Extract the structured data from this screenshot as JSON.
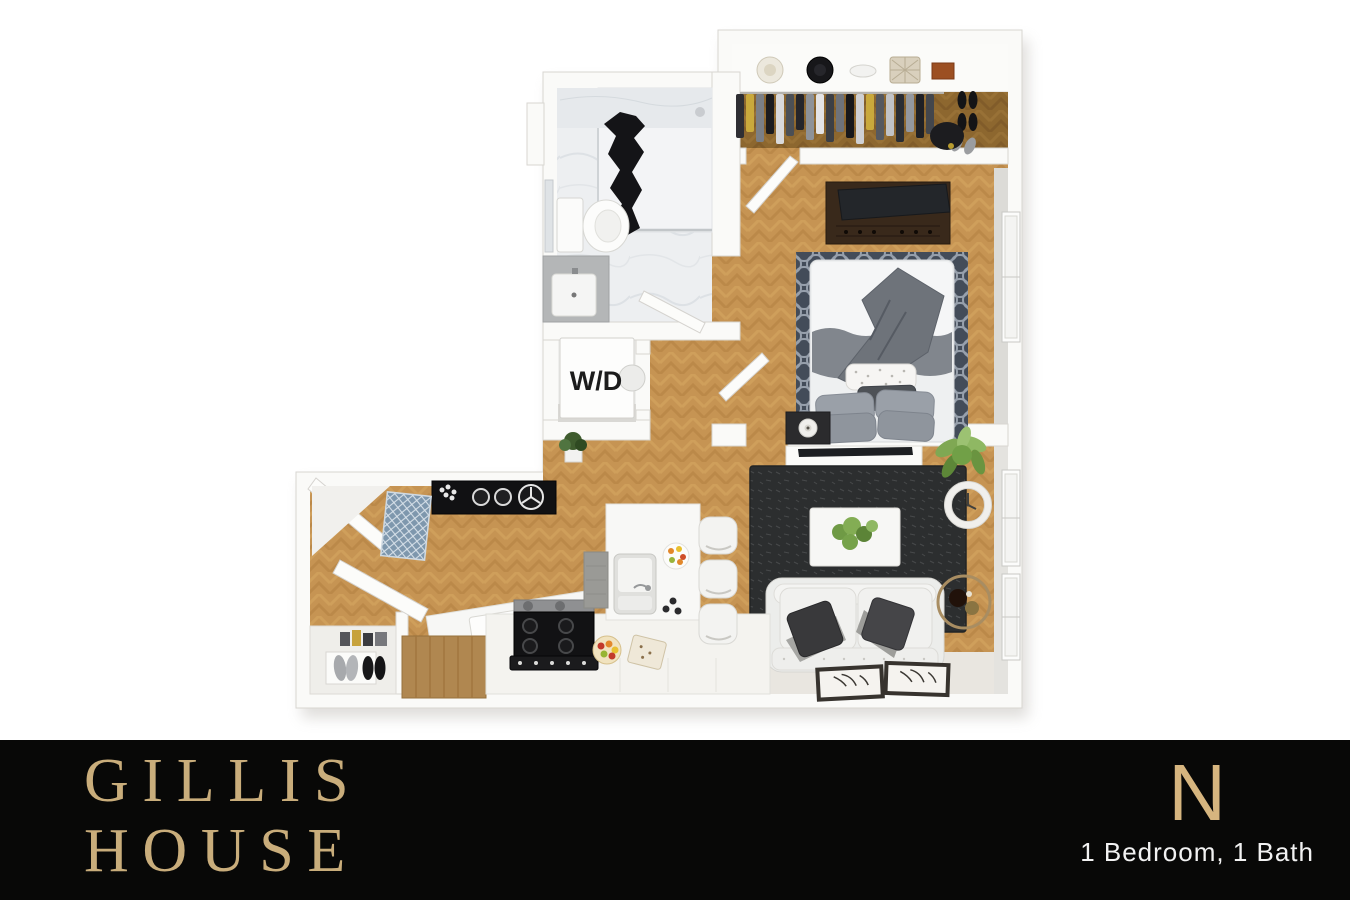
{
  "page": {
    "background_color": "#ffffff"
  },
  "floor_plan": {
    "type": "3d-apartment-floor-plan",
    "laundry_label": "W/D",
    "rooms": [
      "walk-in closet",
      "bathroom",
      "laundry closet",
      "bedroom",
      "living room",
      "kitchen",
      "entry"
    ],
    "colors": {
      "wood_floor": "#c69453",
      "closet_floor": "#8d672f",
      "wall": "#fafaf8",
      "wall_edge": "#d8d6d1",
      "bathroom_marble": "#edeff1",
      "bedroom_rug": "#434c59",
      "living_rug": "#2c2e2f",
      "dresser_wood": "#39291b",
      "entry_mat": "#7e97ad",
      "plant_green": "#7fa853",
      "appliance_black": "#121214"
    }
  },
  "footer": {
    "background_color": "#080807",
    "brand_line1": "GILLIS",
    "brand_line2": "HOUSE",
    "brand_color": "#c9ad7b",
    "plan_letter": "N",
    "plan_letter_color": "#d6b57f",
    "plan_description": "1 Bedroom, 1 Bath",
    "plan_description_color": "#f2f2f2"
  }
}
